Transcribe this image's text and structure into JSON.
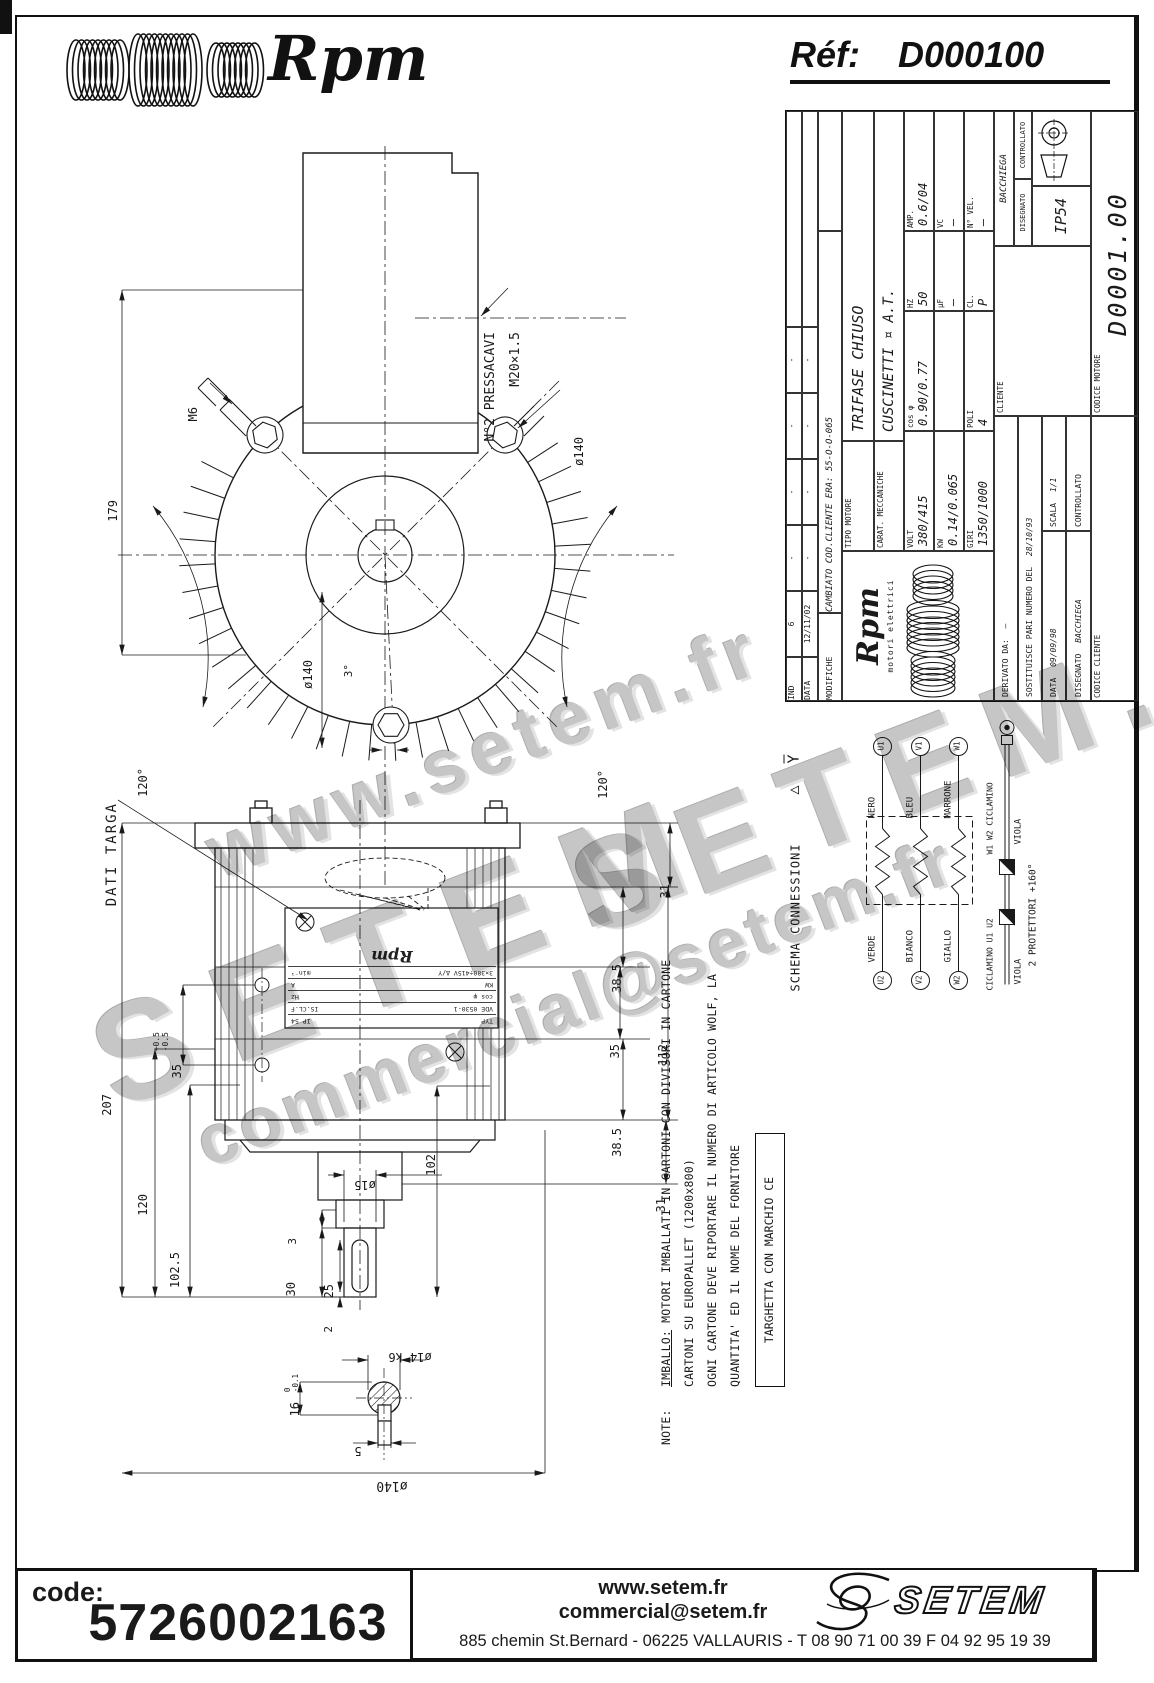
{
  "header": {
    "brand": "Rpm",
    "ref_label": "Réf:",
    "ref_value": "D000100"
  },
  "watermarks": [
    "www.setem.fr",
    "SETEM",
    "commercial@setem.fr",
    "SETEM.fr"
  ],
  "front_view": {
    "labels": {
      "pressacavi1": "N°2 PRESSACAVI",
      "pressacavi2": "M20×1.5",
      "m6": "M6",
      "dia140_leader": "ø140",
      "dia140_dim": "ø140",
      "deg120_left": "120°",
      "deg120_right": "120°",
      "deg3": "3°",
      "h179": "179"
    }
  },
  "side_view": {
    "labels": {
      "dati_targa": "DATI TARGA",
      "d207": "207",
      "d120": "120",
      "d102_5": "102.5",
      "d35": "35",
      "d35_tol": "+0.5\n-0.5",
      "dia15": "ø15",
      "d3": "3",
      "d30": "30",
      "d25": "25",
      "d2": "2",
      "d102": "102",
      "d31_top": "31",
      "d38_5_a": "38.5",
      "d35_r": "35",
      "d38_5_b": "38.5",
      "d112": "112",
      "d31_bottom": "31",
      "dia140_bottom": "ø140",
      "dia14": "ø14 k6",
      "d16": "16",
      "d16_tol": "0\n-0.1",
      "d5": "5"
    },
    "nameplate": {
      "rows": [
        [
          "TYP",
          "IP 54"
        ],
        [
          "VDE 0530-1",
          "IS.CL.F"
        ],
        [
          "cos φ",
          "Hz"
        ],
        [
          "KW",
          "A"
        ],
        [
          "3×380÷415V Δ/Y",
          "min⁻¹"
        ]
      ],
      "logo": "Rpm"
    }
  },
  "title_block": {
    "revisions": {
      "col_ind": "IND",
      "col_data": "DATA",
      "col_mod": "MODIFICHE",
      "ind_value": "6",
      "date_value": "12/11/02",
      "mod_value": "CAMBIATO COD.CLIENTE ERA: 55-O-O-065",
      "empty": "-"
    },
    "fields": {
      "tipo_label": "TIPO MOTORE",
      "tipo_value": "TRIFASE CHIUSO",
      "carat_label": "CARAT. MECCANICHE",
      "carat_value": "CUSCINETTI ¤ A.T.",
      "volt_label": "VOLT",
      "volt_value": "380/415",
      "cos_label": "cos φ",
      "cos_value": "0.90/0.77",
      "hz_label": "HZ",
      "hz_value": "50",
      "amp_label": "AMP.",
      "amp_value": "0.6/04",
      "kw_label": "KW",
      "kw_value": "0.14/0.065",
      "uf_label": "µF",
      "uf_value": "—",
      "vc_label": "VC",
      "vc_value": "—",
      "giri_label": "GIRI",
      "giri_value": "1350/1000",
      "poli_label": "POLI",
      "poli_value": "4",
      "cl_label": "CL.",
      "cl_value": "P",
      "nvel_label": "N° VEL.",
      "nvel_value": "—",
      "ip": "IP54",
      "cliente_label": "CLIENTE",
      "codice_motore_label": "CODICE MOTORE",
      "codice_motore_value": "D0001.00",
      "codice_cliente_label": "CODICE CLIENTE",
      "derivato_label": "DERIVATO DA:",
      "derivato_value": "—",
      "sostituisce_label": "SOSTITUISCE PARI NUMERO DEL",
      "sostituisce_value": "28/10/93",
      "data_label": "DATA",
      "data_value": "09/09/98",
      "scala_label": "SCALA",
      "scala_value": "1/1",
      "disegnato_label": "DISEGNATO",
      "disegnato_value": "BACCHIEGA",
      "controllato_label": "CONTROLLATO",
      "firma_nome": "BACCHIEGA"
    },
    "logo": {
      "brand": "Rpm",
      "sub": "motori elettrici"
    }
  },
  "schema": {
    "title": "SCHEMA CONNESSIONI",
    "delta_symbol": "△",
    "wye_symbol": "Y",
    "windings": [
      {
        "left_terminal": "U2",
        "left_color": "VERDE",
        "right_color": "NERO",
        "right_terminal": "U1"
      },
      {
        "left_terminal": "V2",
        "left_color": "BIANCO",
        "right_color": "BLEU",
        "right_terminal": "V1"
      },
      {
        "left_terminal": "W2",
        "left_color": "GIALLO",
        "right_color": "MARRONE",
        "right_terminal": "W1"
      }
    ],
    "protector": {
      "left_label": "CICLAMINO U1 U2",
      "right_label": "W1 W2 CICLAMINO",
      "left_color": "VIOLA",
      "right_color": "VIOLA",
      "caption": "2 PROTETTORI +160°"
    }
  },
  "notes": {
    "label": "NOTE:",
    "line1_prefix": "IMBALLO:",
    "line1_rest": " MOTORI IMBALLATI IN CARTONI CON DIVISORI IN CARTONE",
    "line2": "CARTONI SU EUROPALLET (1200x800)",
    "line3": "OGNI CARTONE DEVE RIPORTARE IL NUMERO DI ARTICOLO WOLF, LA",
    "line4": "QUANTITA' ED IL NOME DEL FORNITORE",
    "boxed": "TARGHETTA CON MARCHIO CE"
  },
  "footer": {
    "code_label": "code:",
    "code_value": "5726002163",
    "web": "www.setem.fr",
    "email": "commercial@setem.fr",
    "address": "885 chemin St.Bernard  -  06225 VALLAURIS  -  T 08 90 71 00 39   F 04 92 95 19 39",
    "logo_text": "SETEM"
  }
}
